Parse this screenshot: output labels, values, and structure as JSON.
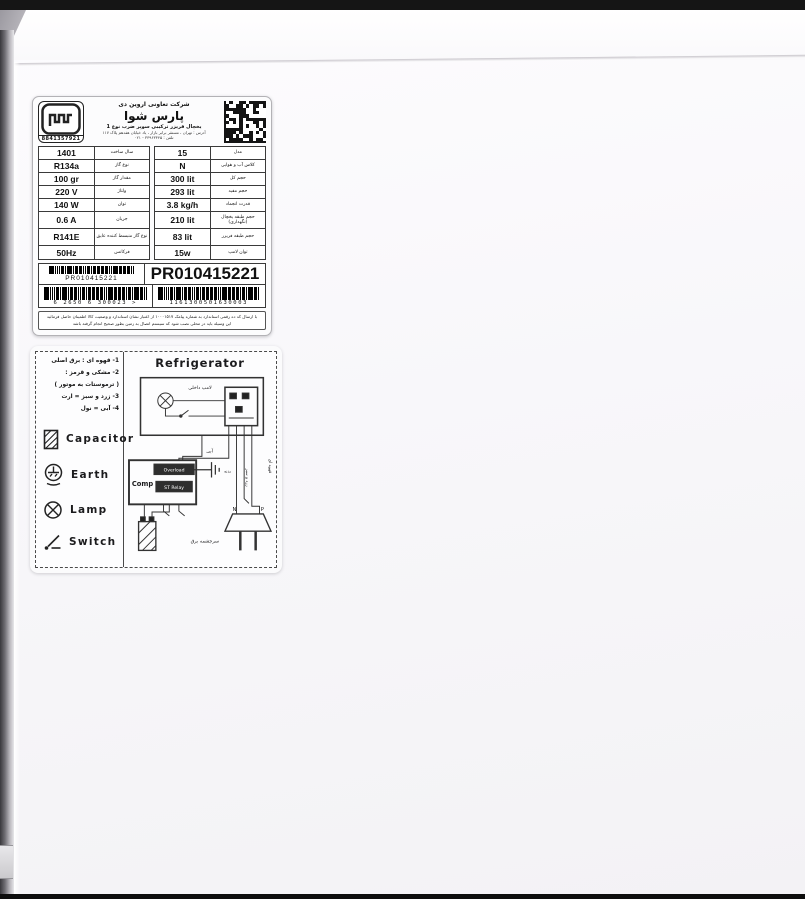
{
  "spec_label": {
    "logo_number": "8841357921",
    "header": {
      "company": "شرکت تعاونی اروین دی",
      "brand": "پارس شوا",
      "product": "یخچال فریزر ترکیبی سوپر ضرب نوع 1",
      "address1": "آدرس : تهران ، مستقر برابر بازار ، یاد خیابان هفدهم پلاک ۱۱۷",
      "address2": "تلفن : ۳۳۹۶۳۳۴۵ - ۰۲۱"
    },
    "table": {
      "rows": [
        {
          "v1": "1401",
          "l1": "سال ساخت",
          "v2": "15",
          "l2": "مدل"
        },
        {
          "v1": "R134a",
          "l1": "نوع گاز",
          "v2": "N",
          "l2": "کلاس آب و هوایی"
        },
        {
          "v1": "100 gr",
          "l1": "مقدار گاز",
          "v2": "300 lit",
          "l2": "حجم کل"
        },
        {
          "v1": "220 V",
          "l1": "ولتاژ",
          "v2": "293 lit",
          "l2": "حجم مفید"
        },
        {
          "v1": "140 W",
          "l1": "توان",
          "v2": "3.8 kg/h",
          "l2": "قدرت انجماد"
        },
        {
          "v1": "0.6 A",
          "l1": "جریان",
          "v2": "210 lit",
          "l2": "حجم طبقه یخچال (نگهداری)"
        },
        {
          "v1": "R141E",
          "l1": "نوع گاز منبسط کننده عایق",
          "v2": "83 lit",
          "l2": "حجم طبقه فریزر"
        },
        {
          "v1": "50Hz",
          "l1": "فرکانس",
          "v2": "15w",
          "l2": "توان لامپ"
        }
      ]
    },
    "serial_small": "PR010415221",
    "serial_large": "PR010415221",
    "barcode_left_digits": "6 2650 6 300023 >",
    "barcode_right_digits": "1161300501630003",
    "footnote1": "با ارسال کد ده رقمی استاندارد به شماره پیامک ۱۰۰۰۱۵۱۷ از اعتبار نشان استاندارد و وضعیت کالا اطمینان حاصل فرمائید",
    "footnote2": "این وسیله باید در محلی نصب شود که سیستم اتصال به زمین بطور صحیح انجام گرفته باشد"
  },
  "wiring_label": {
    "title": "Refrigerator",
    "notes": [
      "1- قهوه ای : برق اصلی",
      "2- مشکی و قرمز :",
      "( ترموستات به موتور )",
      "3- زرد و سبز = ارت",
      "4- آبی = نول"
    ],
    "legend": {
      "capacitor": "Capacitor",
      "earth": "Earth",
      "lamp": "Lamp",
      "switch": "Switch"
    },
    "diagram": {
      "comp": "Comp",
      "overload": "Overload",
      "st_relay": "ST Relay",
      "lamp_label": "لامپ داخلی",
      "wire_blue": "آبی",
      "wire_brown": "قهوه ای",
      "wire_yellow_green": "زرد و سبز",
      "body_label": "بدنه",
      "terminal_n": "N",
      "terminal_p": "P",
      "power_source": "سرچشمه برق"
    }
  }
}
